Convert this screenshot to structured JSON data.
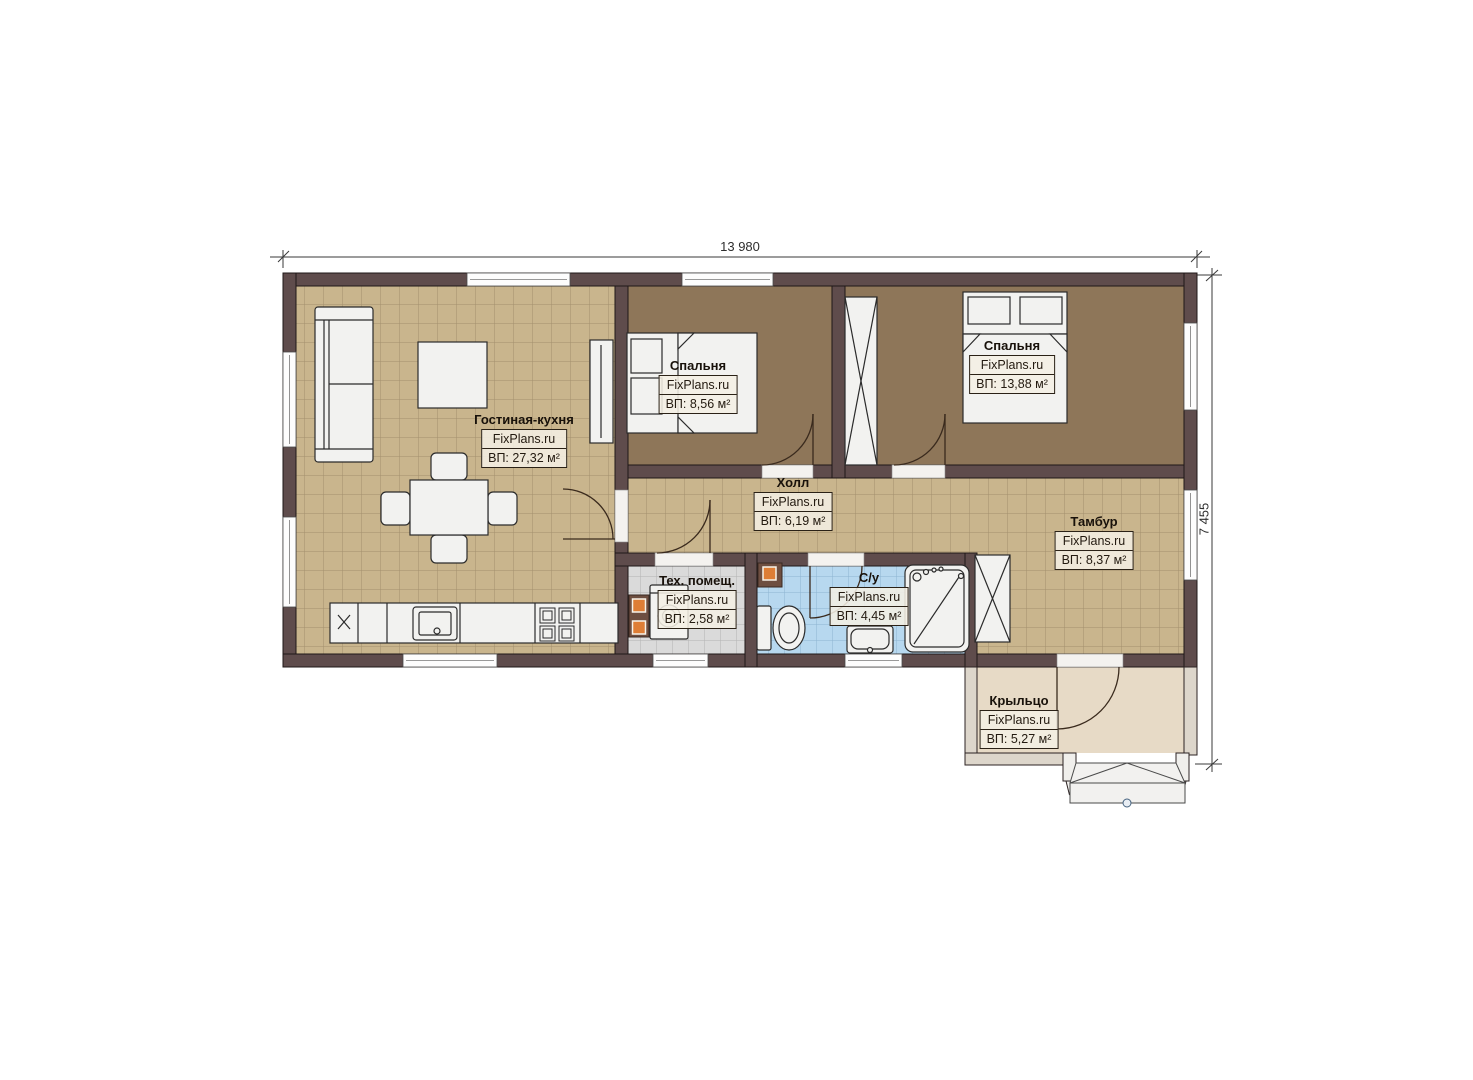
{
  "plan": {
    "brand": "FixPlans.ru",
    "dimensions": {
      "width_label": "13 980",
      "height_label": "7 455"
    },
    "rooms": [
      {
        "id": "living-kitchen",
        "name": "Гостиная-кухня",
        "brand": "FixPlans.ru",
        "area": "ВП: 27,32 м²"
      },
      {
        "id": "bedroom-1",
        "name": "Спальня",
        "brand": "FixPlans.ru",
        "area": "ВП: 8,56 м²"
      },
      {
        "id": "bedroom-2",
        "name": "Спальня",
        "brand": "FixPlans.ru",
        "area": "ВП: 13,88 м²"
      },
      {
        "id": "hall",
        "name": "Холл",
        "brand": "FixPlans.ru",
        "area": "ВП: 6,19 м²"
      },
      {
        "id": "tambour",
        "name": "Тамбур",
        "brand": "FixPlans.ru",
        "area": "ВП: 8,37 м²"
      },
      {
        "id": "tech-room",
        "name": "Тех. помещ.",
        "brand": "FixPlans.ru",
        "area": "ВП: 2,58 м²"
      },
      {
        "id": "bathroom",
        "name": "С/у",
        "brand": "FixPlans.ru",
        "area": "ВП: 4,45 м²"
      },
      {
        "id": "porch",
        "name": "Крыльцо",
        "brand": "FixPlans.ru",
        "area": "ВП: 5,27 м²"
      }
    ],
    "colors": {
      "wall": "#5f4c4c",
      "wall_edge": "#1f1717",
      "floor_tile_tan": "#c9b58d",
      "floor_bedroom": "#8e7659",
      "floor_tech": "#dadada",
      "floor_bath": "#b7d8ef",
      "floor_porch": "#e7dac6",
      "furniture": "#f2f2f0",
      "equipment_orange": "#de7e36"
    }
  }
}
